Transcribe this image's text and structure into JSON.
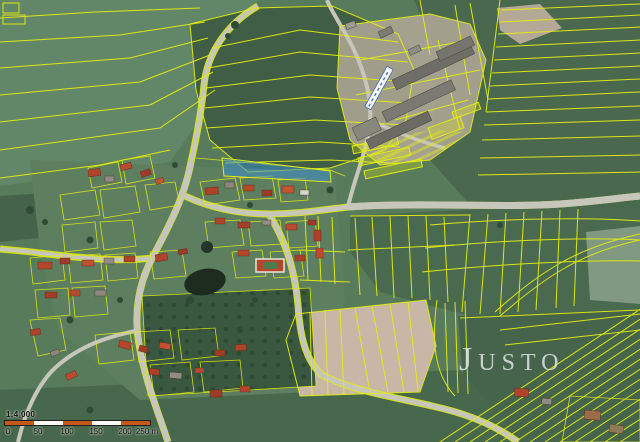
{
  "map": {
    "name": "aerial-cadastral-map",
    "watermark": "Justo",
    "overlay_color": "#e3ec12",
    "highlight_color": "#3c8ccb"
  },
  "scale_bar": {
    "ratio": "1:4 000",
    "ticks": [
      "0",
      "50",
      "100",
      "150",
      "200",
      "250 m"
    ],
    "bar_colors": {
      "primary": "#c2591b",
      "secondary": "#f8f8f4"
    }
  }
}
